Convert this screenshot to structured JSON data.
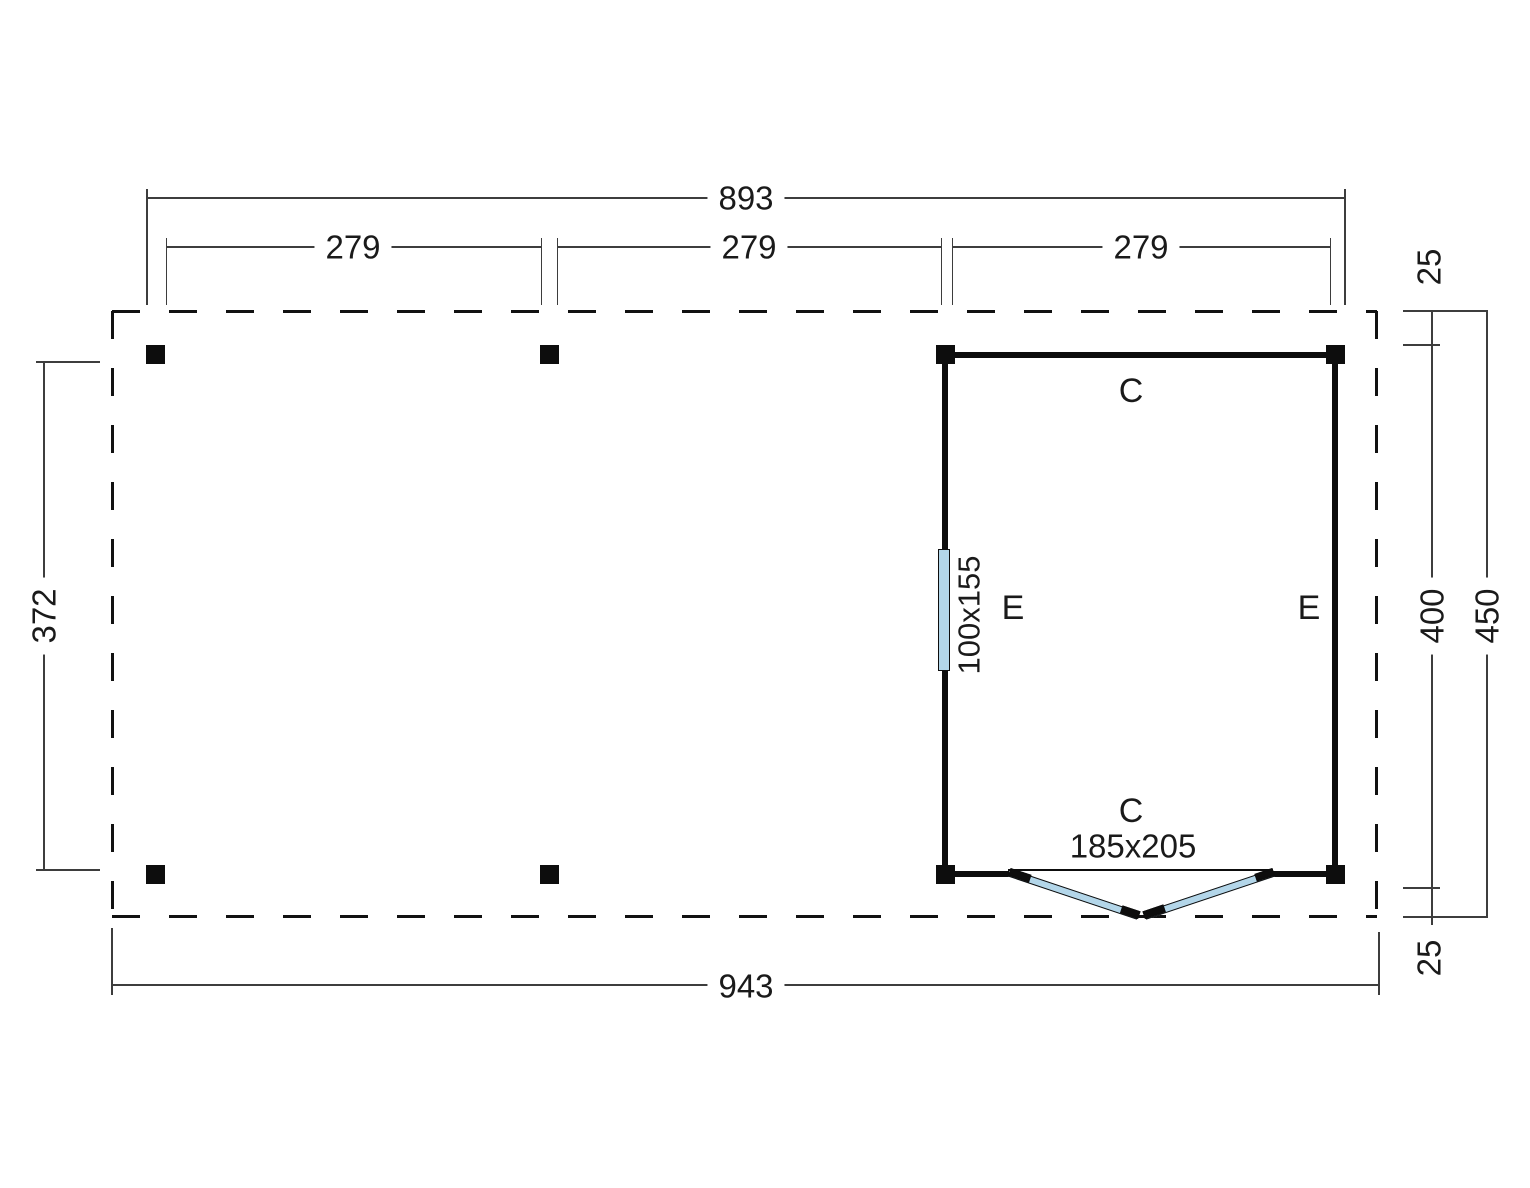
{
  "plan": {
    "dims": {
      "top_total": "893",
      "top_seg_1": "279",
      "top_seg_2": "279",
      "top_seg_3": "279",
      "overhang_top": "25",
      "room_depth": "400",
      "total_depth": "450",
      "overhang_bottom": "25",
      "bottom_total": "943",
      "post_span_left": "372"
    },
    "room": {
      "top_wall_label": "C",
      "left_wall_label": "E",
      "right_wall_label": "E",
      "door_wall_label": "C",
      "door_size": "185x205",
      "window_size": "100x155"
    },
    "colors": {
      "glass": "#b3d6e9",
      "wall": "#0d0d0d",
      "dim_line": "#3d3d3d",
      "text": "#1a1a1a",
      "background": "#ffffff"
    }
  }
}
